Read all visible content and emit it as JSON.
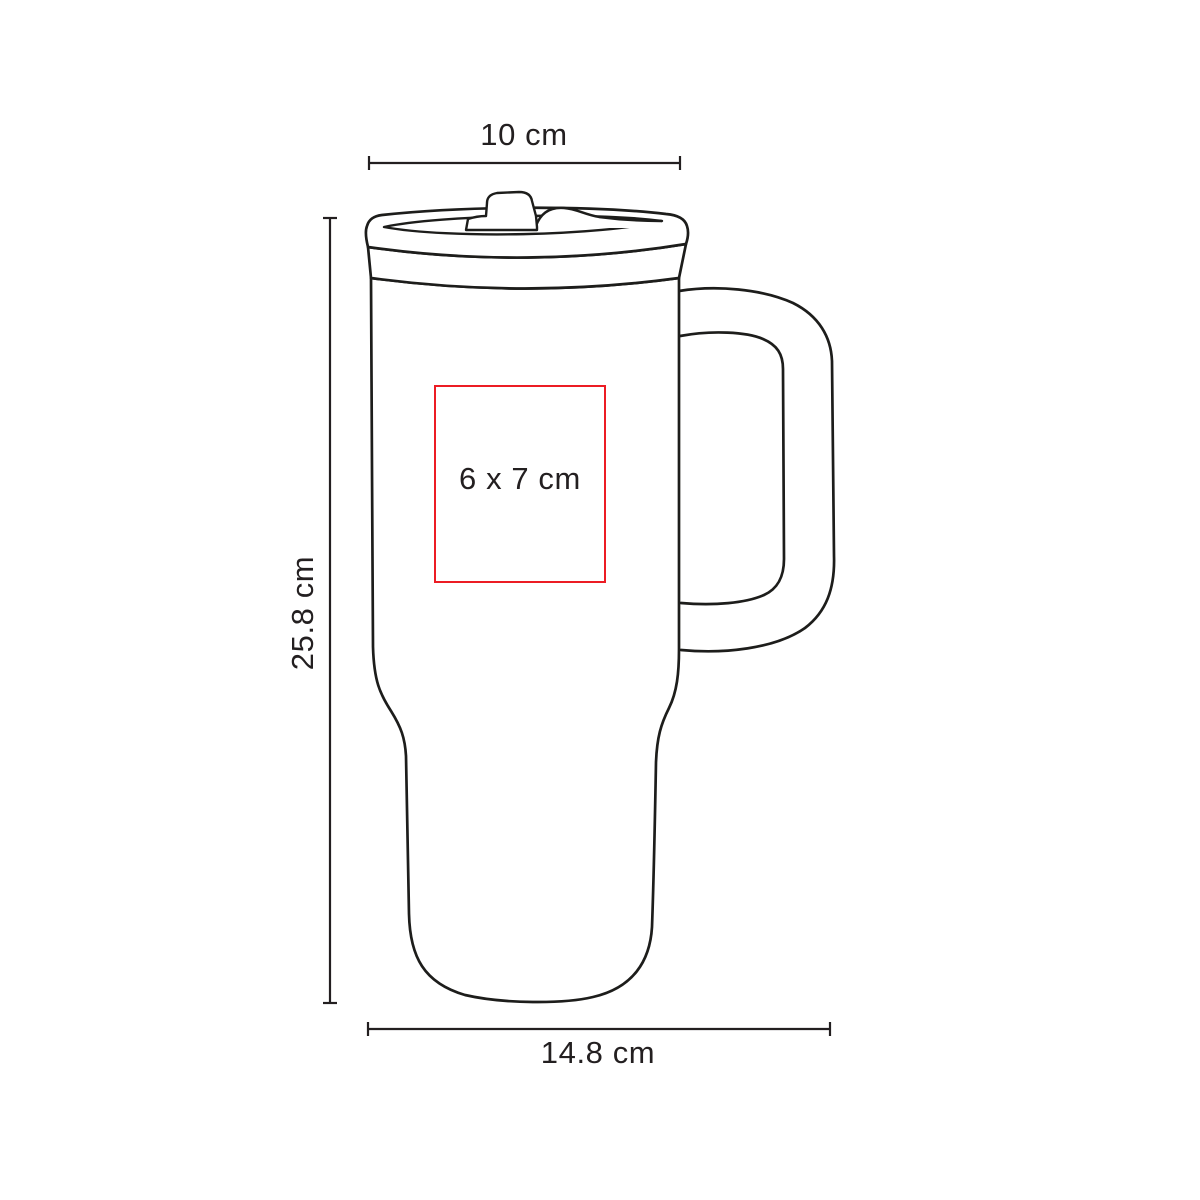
{
  "canvas": {
    "background": "#ffffff"
  },
  "diagram": {
    "product_art": "travel-mug-with-handle-line-art",
    "outline_color": "#1d1d1b",
    "text_color": "#231f20",
    "labels": {
      "top_width": "10 cm",
      "height": "25.8 cm",
      "bottom_width": "14.8 cm",
      "imprint_area": "6 x 7 cm"
    },
    "imprint_box": {
      "border_color": "#ec1c24"
    }
  }
}
